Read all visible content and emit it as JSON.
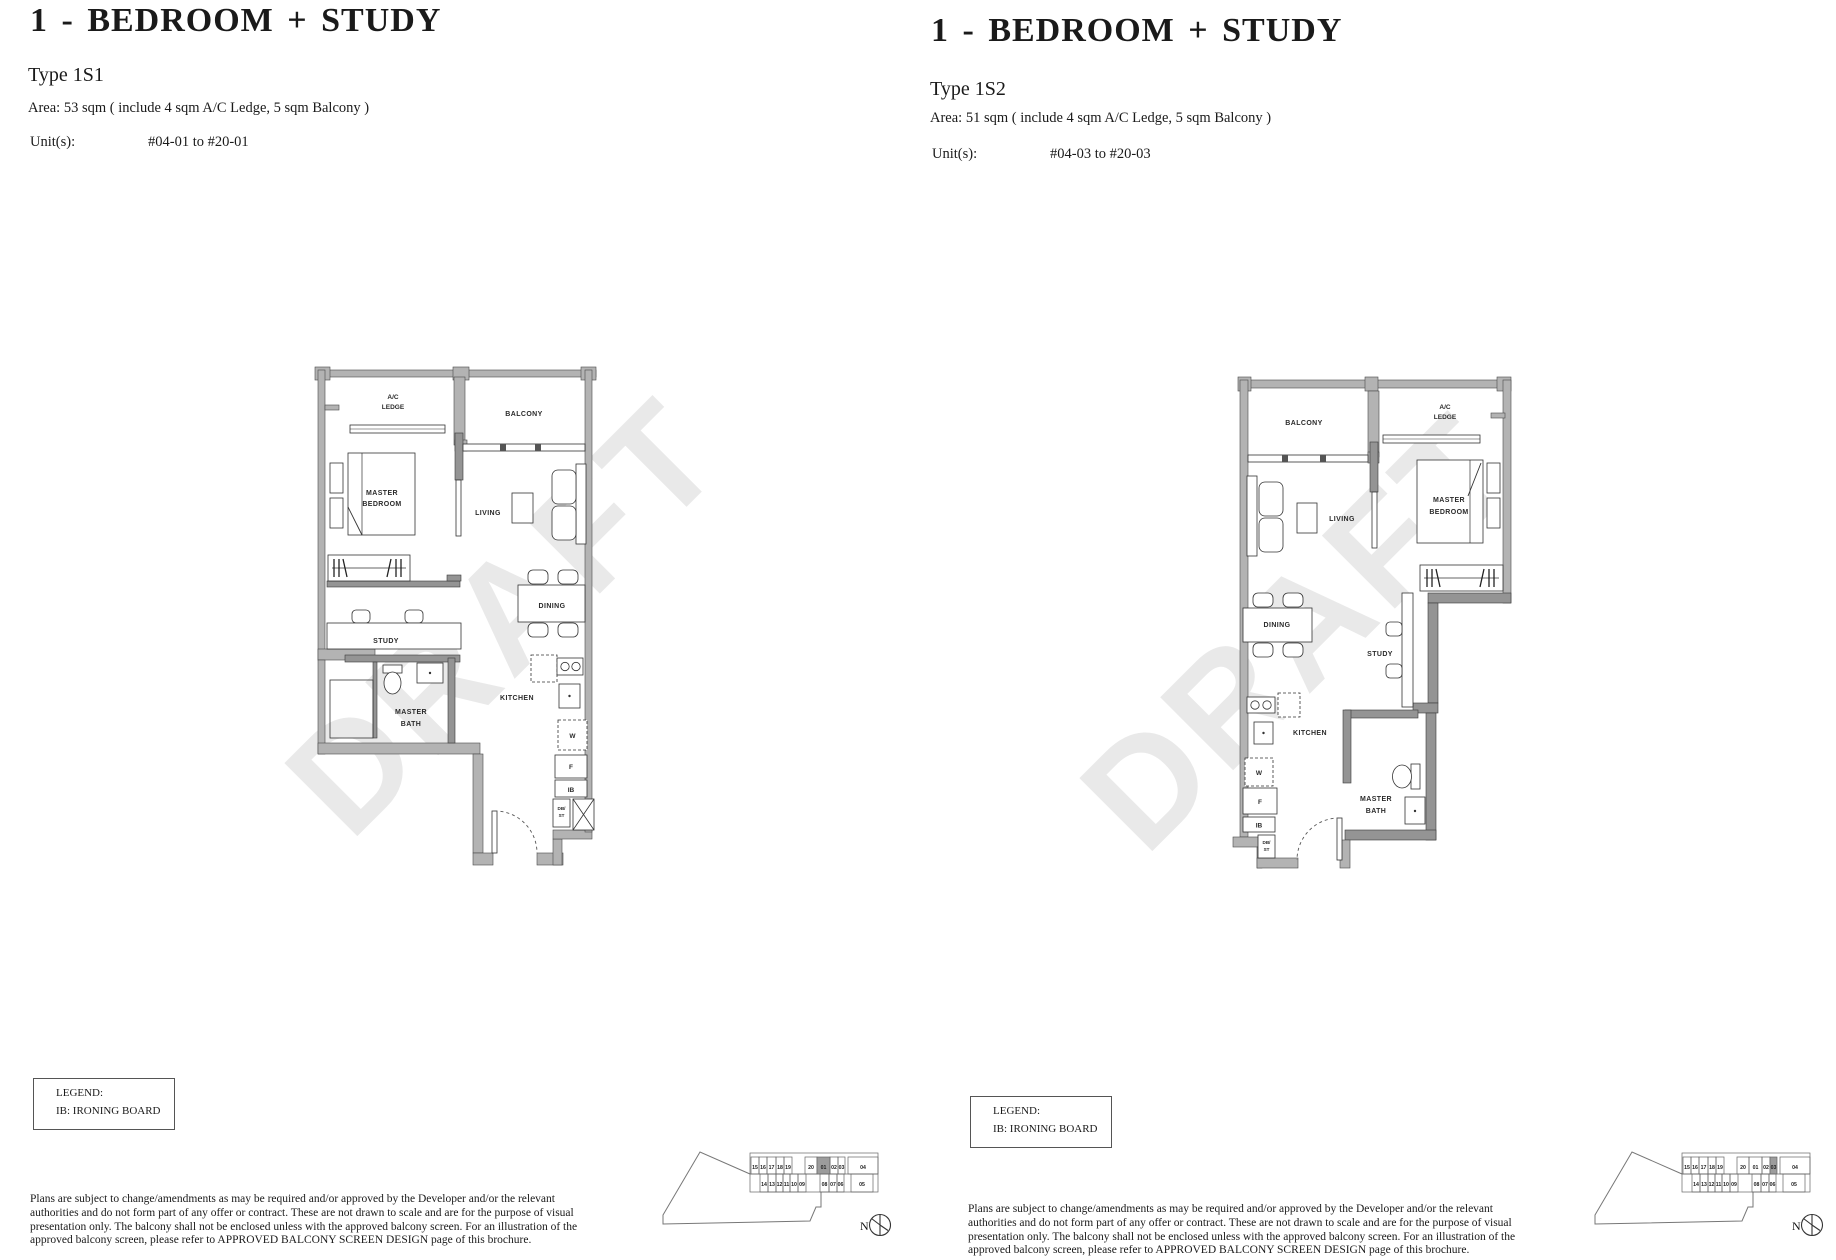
{
  "watermark": "DRAFT",
  "units": [
    {
      "title": "1 - BEDROOM + STUDY",
      "type_label": "Type 1S1",
      "area_line": "Area: 53 sqm ( include 4 sqm A/C Ledge, 5 sqm Balcony )",
      "units_label": "Unit(s):",
      "units_value": "#04-01 to #20-01",
      "keyplan_highlight": "01"
    },
    {
      "title": "1 - BEDROOM + STUDY",
      "type_label": "Type 1S2",
      "area_line": "Area: 51 sqm ( include 4 sqm A/C Ledge, 5 sqm Balcony )",
      "units_label": "Unit(s):",
      "units_value": "#04-03 to #20-03",
      "keyplan_highlight": "03"
    }
  ],
  "legend": {
    "title": "LEGEND:",
    "item": "IB: IRONING BOARD"
  },
  "disclaimer": "Plans are subject to change/amendments as may be required and/or approved by the Developer and/or the relevant authorities and do not form part of any offer or contract. These are not drawn to scale and are for the purpose of visual presentation only. The balcony shall not be enclosed unless with the approved balcony screen. For an illustration of the approved balcony screen, please refer to APPROVED BALCONY SCREEN DESIGN page of this brochure.",
  "plan_labels": {
    "ac_1": "A/C",
    "ac_2": "LEDGE",
    "balcony": "BALCONY",
    "mbr_1": "MASTER",
    "mbr_2": "BEDROOM",
    "living": "LIVING",
    "dining": "DINING",
    "study": "STUDY",
    "bath_1": "MASTER",
    "bath_2": "BATH",
    "kitchen": "KITCHEN",
    "w": "W",
    "f": "F",
    "ib": "IB",
    "db_1": "DB/",
    "db_2": "ST"
  },
  "keyplan": {
    "north_label": "N",
    "top_row": [
      "15",
      "16",
      "17",
      "18",
      "19",
      "20",
      "01",
      "02",
      "03",
      "04"
    ],
    "bottom_row": [
      "14",
      "13",
      "12",
      "11",
      "10",
      "09",
      "08",
      "07",
      "06",
      "05"
    ]
  },
  "colors": {
    "wall": "#b3b3b3",
    "highlight": "#9c9c9c",
    "watermark_gray": "#e9e9e9"
  }
}
